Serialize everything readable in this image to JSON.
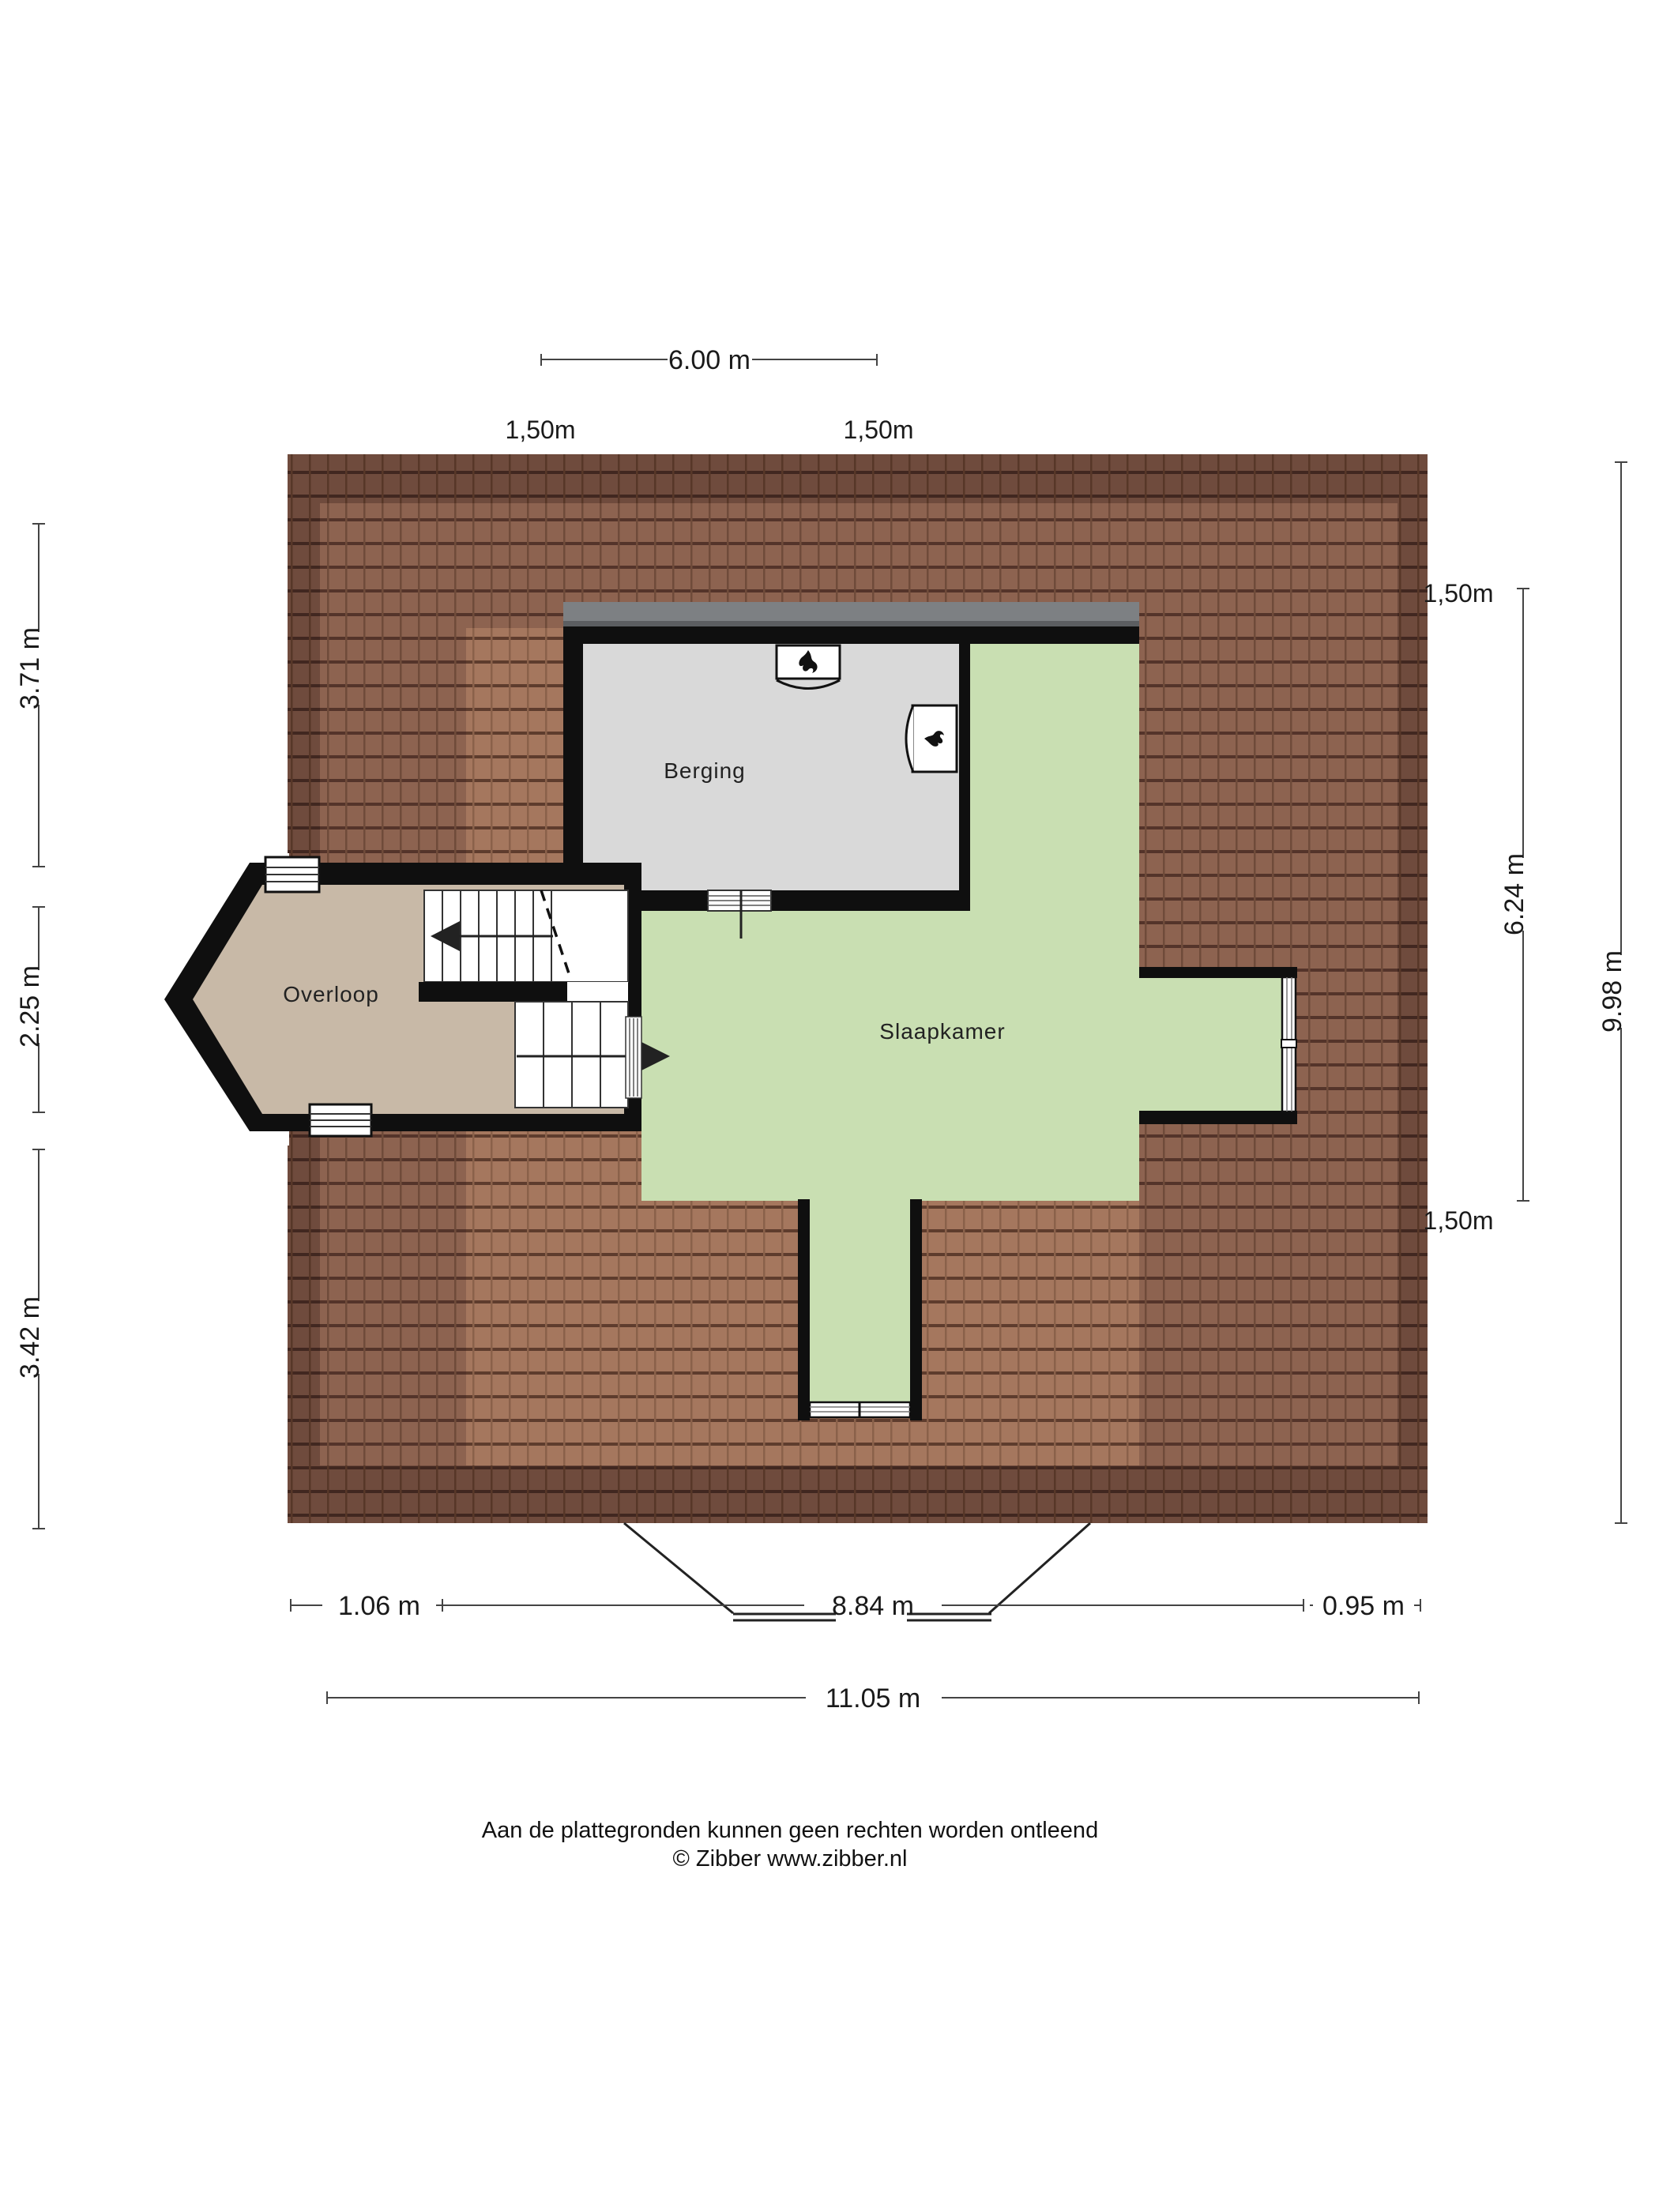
{
  "page": {
    "type": "floorplan",
    "background": "#ffffff"
  },
  "rooms": {
    "berging": "Berging",
    "overloop": "Overloop",
    "slaapkamer": "Slaapkamer"
  },
  "dimensions": {
    "top": {
      "width": "6.00 m",
      "left_margin": "1,50m",
      "right_margin": "1,50m"
    },
    "left": {
      "top": "3.71 m",
      "middle": "2.25 m",
      "bottom": "3.42 m"
    },
    "right": {
      "top_margin": "1,50m",
      "inner_height": "6.24 m",
      "total_height": "9.98 m",
      "bottom_margin": "1,50m"
    },
    "bottom": {
      "left": "1.06 m",
      "middle": "8.84 m",
      "right": "0.95 m",
      "total": "11.05 m"
    }
  },
  "footer": {
    "line1": "Aan de plattegronden kunnen geen rechten worden ontleend",
    "line2": "© Zibber www.zibber.nl"
  },
  "icons": {
    "boiler_flame": "flame-icon"
  },
  "colors": {
    "wall": "#0f0f0f",
    "roof_dark": "#6f4b3d",
    "roof_medium": "#8d6350",
    "roof_light": "#a5775e",
    "berging_floor": "#d9d9d9",
    "slaapkamer_floor": "#c9dfb2",
    "overloop_floor": "#c8b9a7",
    "dormer_roof_band": "#7d8083",
    "dimension_line": "#444444",
    "text": "#1a1a1a"
  }
}
